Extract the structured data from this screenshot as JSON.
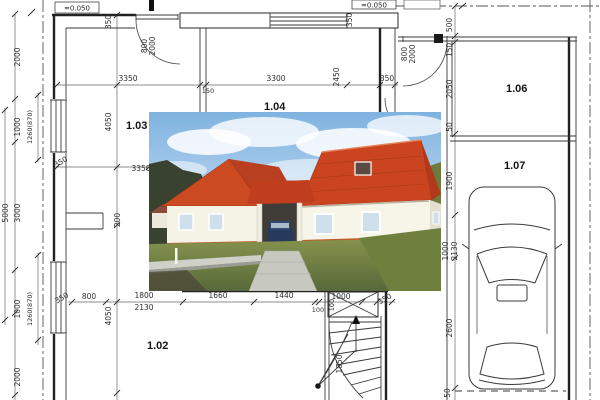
{
  "plan": {
    "title": "ground-floor plan with house photo inset",
    "elevations": {
      "left": "=0.050",
      "right": "=0.050"
    },
    "rooms": [
      "1.02",
      "1.03",
      "1.04",
      "1.06",
      "1.07"
    ],
    "dims": {
      "left_outer": [
        "2000",
        "1000",
        "3000",
        "1000",
        "2000"
      ],
      "left_overall": "5000",
      "left_sills": [
        "1260(870)",
        "1260(870)"
      ],
      "inner_vertical": [
        "350",
        "4050",
        "200",
        "4050"
      ],
      "top": [
        "3350",
        "150",
        "3300",
        "2450",
        "350"
      ],
      "top_wall": "350",
      "door_top_left": [
        "800",
        "2000"
      ],
      "door_right": [
        "800",
        "2000"
      ],
      "mid": [
        "350",
        "3350"
      ],
      "bottom": [
        "350",
        "800",
        "1800",
        "2130",
        "1660",
        "1440",
        "100",
        "1000",
        "350"
      ],
      "right_chain": [
        "500",
        "150",
        "2050",
        "50",
        "1900",
        "1000",
        "2130",
        "2600",
        "50"
      ],
      "stairs": [
        "100",
        "1850"
      ]
    },
    "colors": {
      "line": "#222222",
      "dim_text": "#2f2f2f",
      "roof": "#c9441f",
      "wall_render": "#f5f3e6",
      "sky": "#7fb2e0"
    }
  }
}
